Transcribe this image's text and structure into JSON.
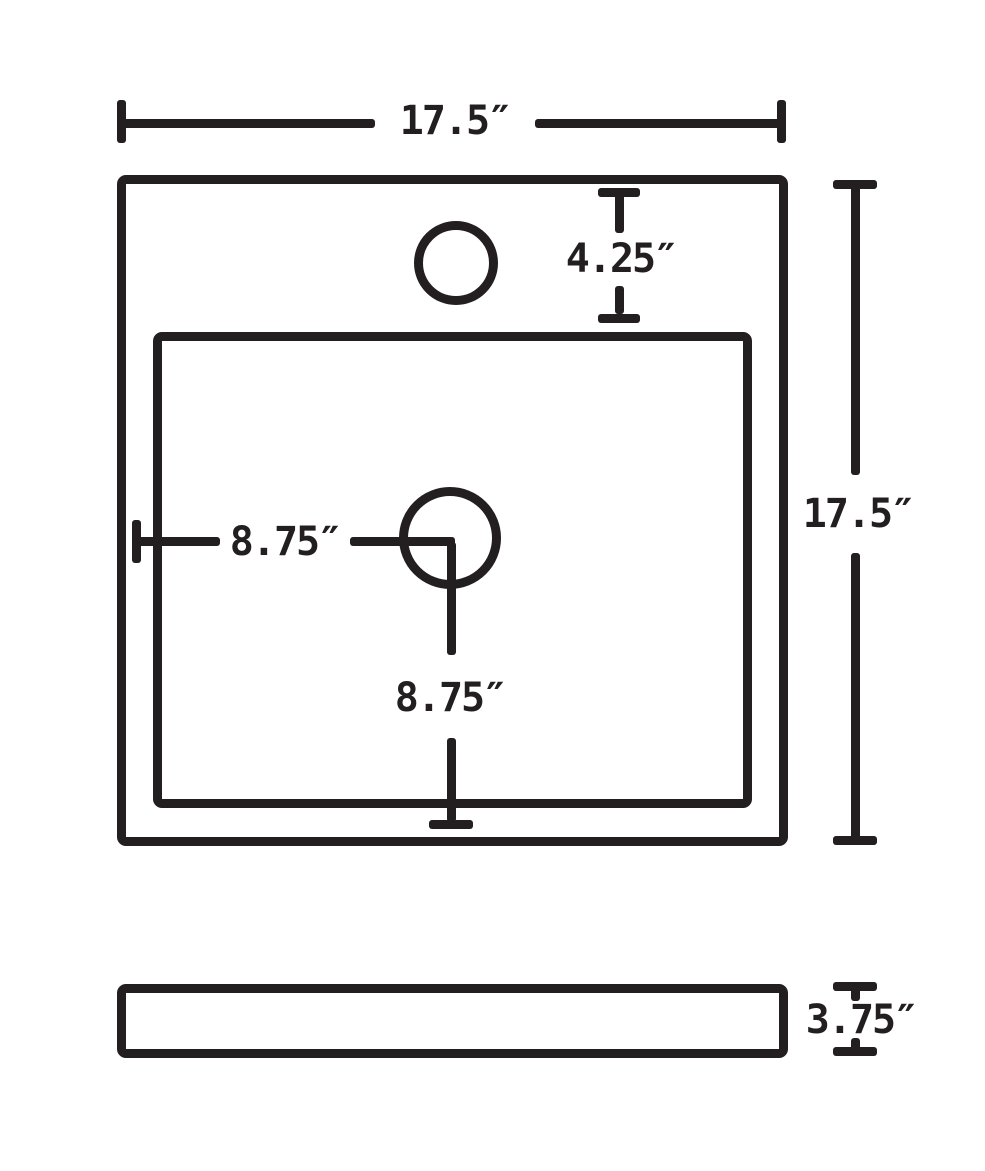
{
  "drawing": {
    "title": "Sink dimension technical drawing (top view and side view)",
    "ink_color": "#231f20",
    "background_color": "#ffffff",
    "views": {
      "top_view": "Square sink rim with inner basin, faucet hole at top center, drain hole at basin center",
      "side_view": "Thin horizontal profile of sink apron"
    },
    "dimensions": {
      "top_width": "17.5″",
      "right_depth": "17.5″",
      "faucet_setback": "4.25″",
      "drain_offset_horizontal": "8.75″",
      "drain_offset_vertical": "8.75″",
      "side_view_height": "3.75″"
    }
  }
}
